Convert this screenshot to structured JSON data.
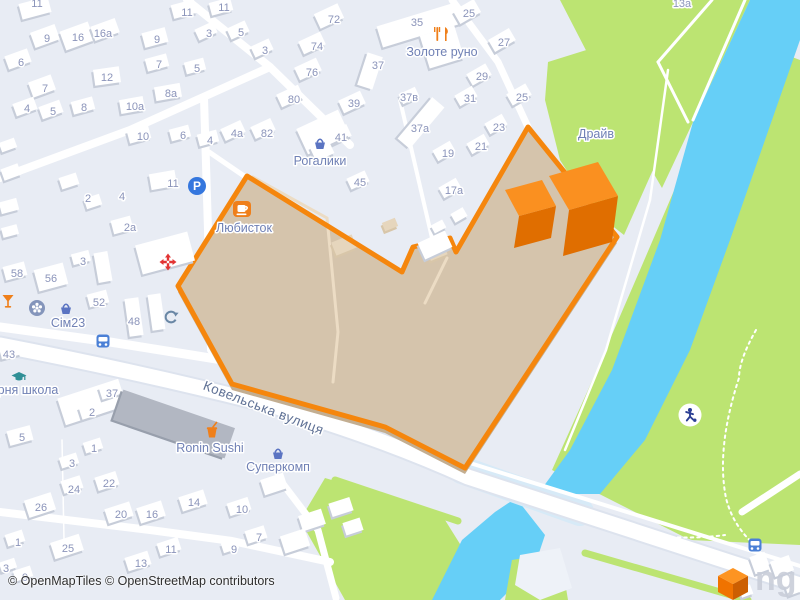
{
  "attribution": "© OpenMapTiles © OpenStreetMap contributors",
  "watermark": "ng",
  "colors": {
    "land": "#e8ecf4",
    "green": "#bce472",
    "water": "#66cff7",
    "bridge": "#d7eaf7",
    "road": "#ffffff",
    "road_casing": "#dde3ee",
    "building": "#ffffff",
    "building_shadow": "#c7cdd9",
    "building_gray": "#b2b7c2",
    "building_gray_shadow": "#989fac",
    "building_beige": "#e6d6bd",
    "selection_fill": "#d5c4ac",
    "selection_lip": "#c3ae91",
    "selection_border": "#f5860d",
    "selection_path": "#ecdcc4",
    "bld3d_top": "#fa9020",
    "bld3d_side": "#e06e00",
    "house_number": "#8b94ba",
    "poi_label": "#7081b5",
    "street_label": "#5f7195",
    "icon_orange": "#ef7f1a",
    "icon_blue": "#3577de",
    "icon_basket": "#5b74c2",
    "icon_red": "#e23434",
    "icon_slate": "#6a87a5",
    "icon_teal": "#2f8f96",
    "icon_navy": "#2b3f94",
    "logo_top": "#fd9422",
    "logo_left": "#f07300",
    "logo_right": "#cc5f02"
  },
  "selection": {
    "points": "247,176 402,272 413,247 450,238 456,252 528,127 617,237 465,468 385,427 232,384 178,286",
    "inner_paths": [
      "M253 177 L327 218 L338 332 L333 382",
      "M447 258 L425 303"
    ]
  },
  "areas": {
    "wedge_green": "560,0 750,0 693,122 662,188 640,150 592,62",
    "drive_green": "548,62 612,42 658,90 652,172 624,235 592,210 560,160 545,100",
    "park_green": "760,45 800,60 800,545 690,540 552,470 588,390 640,270 700,130",
    "bottomleft_green": "325,478 440,512 470,560 455,600 345,600 300,520",
    "bottomright_green": "512,560 560,552 568,600 505,600",
    "river": "750,0 800,0 800,40 772,120 730,240 690,350 645,440 600,494 538,494 570,450 612,370 660,240 693,122",
    "river_bottom": "516,498 545,535 535,565 500,600 432,600 462,540 495,512",
    "island": "520,555 560,548 572,588 540,600 515,585",
    "bridge": {
      "d": "M462 470 L580 512",
      "w": 28
    }
  },
  "verges": [
    {
      "d": "M238 392 L462 468",
      "w": 8
    },
    {
      "d": "M335 480 L458 521",
      "w": 7
    },
    {
      "d": "M585 553 L748 600",
      "w": 7
    }
  ],
  "roads": [
    {
      "d": "M0 345 Q140 372 270 405 Q380 437 468 477 L800 585",
      "w": 15,
      "casing": true
    },
    {
      "d": "M470 463 L800 566",
      "w": 4
    },
    {
      "d": "M0 327 L110 342 L235 362 L272 390",
      "w": 9
    },
    {
      "d": "M187 0 L270 67 L350 145",
      "w": 8
    },
    {
      "d": "M270 67 L130 130 L0 178",
      "w": 8
    },
    {
      "d": "M204 98 L208 230 L211 350",
      "w": 8
    },
    {
      "d": "M209 152 L247 178",
      "w": 5
    },
    {
      "d": "M452 0 L498 62 L528 127",
      "w": 7
    },
    {
      "d": "M400 100 L432 238",
      "w": 4
    },
    {
      "d": "M0 512 L150 530 L232 541 L330 562",
      "w": 8
    },
    {
      "d": "M280 480 L318 530 L336 598",
      "w": 7
    },
    {
      "d": "M742 512 L800 474",
      "w": 7
    },
    {
      "d": "M62 440 L64 540",
      "w": 1.5
    }
  ],
  "park_paths": [
    {
      "d": "M712 0 L658 62",
      "w": 3
    },
    {
      "d": "M658 62 L688 122",
      "w": 3
    },
    {
      "d": "M745 0 L693 120",
      "w": 3
    },
    {
      "d": "M668 70 L650 200 L606 350 L565 450",
      "w": 2.5
    },
    {
      "d": "M756 330 Q739 360 739 378 Q716 448 726 498 Q733 527 758 548",
      "w": 2,
      "dash": "2.5 4"
    },
    {
      "d": "M570 515 Q650 545 725 535",
      "w": 2,
      "dash": "2.5 4"
    }
  ],
  "buildings": [
    [
      20,
      0,
      30,
      16,
      -15
    ],
    [
      172,
      2,
      24,
      14,
      -15
    ],
    [
      210,
      0,
      22,
      13,
      -15
    ],
    [
      32,
      28,
      26,
      16,
      -20
    ],
    [
      62,
      26,
      30,
      20,
      -20
    ],
    [
      92,
      22,
      26,
      15,
      -20
    ],
    [
      143,
      30,
      24,
      15,
      -15
    ],
    [
      196,
      25,
      20,
      12,
      -25
    ],
    [
      228,
      24,
      20,
      12,
      -25
    ],
    [
      316,
      8,
      26,
      16,
      -25
    ],
    [
      6,
      52,
      24,
      14,
      -20
    ],
    [
      30,
      78,
      24,
      16,
      -20
    ],
    [
      94,
      68,
      26,
      16,
      -8
    ],
    [
      146,
      56,
      22,
      13,
      -15
    ],
    [
      185,
      60,
      20,
      12,
      -15
    ],
    [
      252,
      42,
      20,
      12,
      -25
    ],
    [
      300,
      36,
      24,
      14,
      -25
    ],
    [
      296,
      62,
      24,
      14,
      -25
    ],
    [
      14,
      100,
      22,
      13,
      -20
    ],
    [
      40,
      103,
      22,
      13,
      -20
    ],
    [
      72,
      99,
      22,
      13,
      -15
    ],
    [
      155,
      85,
      26,
      14,
      -10
    ],
    [
      120,
      98,
      24,
      14,
      -10
    ],
    [
      278,
      89,
      24,
      14,
      -25
    ],
    [
      252,
      122,
      22,
      13,
      -25
    ],
    [
      222,
      124,
      22,
      13,
      -25
    ],
    [
      128,
      128,
      22,
      13,
      -15
    ],
    [
      170,
      127,
      20,
      12,
      -15
    ],
    [
      198,
      132,
      20,
      12,
      -15
    ],
    [
      150,
      172,
      26,
      16,
      -10
    ],
    [
      0,
      140,
      16,
      10,
      -20
    ],
    [
      2,
      166,
      18,
      12,
      -20
    ],
    [
      60,
      175,
      18,
      12,
      -18
    ],
    [
      85,
      196,
      16,
      11,
      -18
    ],
    [
      0,
      200,
      18,
      12,
      -15
    ],
    [
      2,
      226,
      16,
      10,
      -15
    ],
    [
      138,
      238,
      54,
      30,
      -15
    ],
    [
      112,
      218,
      20,
      14,
      -15
    ],
    [
      378,
      14,
      82,
      22,
      -17
    ],
    [
      424,
      30,
      36,
      34,
      -17
    ],
    [
      362,
      54,
      16,
      34,
      18
    ],
    [
      340,
      95,
      24,
      14,
      -25
    ],
    [
      328,
      128,
      22,
      13,
      -25
    ],
    [
      348,
      174,
      20,
      12,
      -25
    ],
    [
      300,
      118,
      46,
      28,
      -25
    ],
    [
      312,
      142,
      20,
      16,
      -25
    ],
    [
      400,
      90,
      18,
      11,
      -25
    ],
    [
      413,
      96,
      16,
      54,
      40
    ],
    [
      455,
      4,
      24,
      15,
      -30
    ],
    [
      490,
      33,
      24,
      14,
      -30
    ],
    [
      468,
      68,
      22,
      13,
      -30
    ],
    [
      456,
      90,
      20,
      12,
      -30
    ],
    [
      508,
      88,
      22,
      13,
      -30
    ],
    [
      486,
      118,
      20,
      12,
      -30
    ],
    [
      434,
      145,
      20,
      12,
      -30
    ],
    [
      468,
      138,
      20,
      12,
      -30
    ],
    [
      440,
      182,
      20,
      12,
      -30
    ],
    [
      452,
      210,
      14,
      10,
      -30
    ],
    [
      432,
      222,
      13,
      9,
      -28
    ],
    [
      4,
      264,
      22,
      14,
      -15
    ],
    [
      36,
      266,
      30,
      22,
      -15
    ],
    [
      72,
      252,
      18,
      11,
      -15
    ],
    [
      96,
      252,
      14,
      30,
      -10
    ],
    [
      88,
      292,
      20,
      13,
      -15
    ],
    [
      127,
      298,
      14,
      38,
      -8
    ],
    [
      150,
      294,
      13,
      36,
      -8
    ],
    [
      0,
      344,
      20,
      13,
      -15
    ],
    [
      60,
      388,
      64,
      28,
      -18
    ],
    [
      100,
      384,
      20,
      13,
      -18
    ],
    [
      80,
      404,
      20,
      13,
      -18
    ],
    [
      8,
      428,
      24,
      15,
      -15
    ],
    [
      84,
      440,
      18,
      11,
      -18
    ],
    [
      60,
      455,
      18,
      11,
      -18
    ],
    [
      26,
      496,
      28,
      18,
      -18
    ],
    [
      62,
      478,
      20,
      13,
      -18
    ],
    [
      96,
      474,
      22,
      14,
      -18
    ],
    [
      106,
      505,
      26,
      15,
      -18
    ],
    [
      138,
      504,
      26,
      16,
      -18
    ],
    [
      180,
      493,
      26,
      15,
      -18
    ],
    [
      52,
      538,
      30,
      17,
      -18
    ],
    [
      158,
      540,
      22,
      13,
      -18
    ],
    [
      126,
      554,
      24,
      14,
      -18
    ],
    [
      6,
      532,
      18,
      12,
      -18
    ],
    [
      0,
      560,
      16,
      10,
      -18
    ],
    [
      14,
      568,
      18,
      11,
      -18
    ],
    [
      228,
      500,
      22,
      13,
      -18
    ],
    [
      246,
      528,
      20,
      13,
      -18
    ],
    [
      222,
      541,
      16,
      10,
      -18
    ],
    [
      300,
      512,
      24,
      16,
      -18
    ],
    [
      330,
      500,
      22,
      14,
      -18
    ],
    [
      282,
      532,
      26,
      18,
      -18
    ],
    [
      344,
      520,
      18,
      13,
      -18
    ],
    [
      262,
      476,
      24,
      16,
      -18
    ],
    [
      752,
      554,
      16,
      18,
      -20
    ],
    [
      772,
      558,
      20,
      16,
      -20
    ],
    [
      786,
      582,
      14,
      12,
      -20
    ],
    [
      740,
      586,
      12,
      10,
      -20
    ]
  ],
  "gray_buildings": [
    [
      115,
      408,
      118,
      32,
      19
    ]
  ],
  "beige_buildings": [
    [
      333,
      238,
      22,
      14,
      -22
    ],
    [
      383,
      220,
      14,
      9,
      -22
    ],
    [
      428,
      246,
      18,
      12,
      -22
    ]
  ],
  "notch_building": [
    420,
    236,
    30,
    18,
    -25
  ],
  "buildings_3d": [
    {
      "top": "505,190 542,180 556,206 519,216",
      "side": "519,216 556,206 551,238 514,248"
    },
    {
      "top": "549,176 598,162 618,196 569,210",
      "side": "569,210 618,196 612,242 563,256"
    }
  ],
  "street_label": {
    "text": "Ковельська вулиця",
    "x": 262,
    "y": 412,
    "rotate": 21,
    "size": 13.5
  },
  "poi_labels": [
    {
      "label": "Золоте руно",
      "icon": "forkknife",
      "ix": 442,
      "iy": 34,
      "lx": 442,
      "ly": 56
    },
    {
      "label": "Рогалики",
      "icon": "basket",
      "ix": 320,
      "iy": 144,
      "lx": 320,
      "ly": 165
    },
    {
      "label": "Любисток",
      "icon": "coffee",
      "ix": 242,
      "iy": 209,
      "lx": 244,
      "ly": 232
    },
    {
      "label": "Сім23",
      "icon": "basket",
      "ix": 66,
      "iy": 309,
      "lx": 68,
      "ly": 327
    },
    {
      "label": "Драйв",
      "icon": "",
      "ix": 0,
      "iy": 0,
      "lx": 596,
      "ly": 138
    },
    {
      "label": "Ronin Sushi",
      "icon": "fastfood",
      "ix": 212,
      "iy": 431,
      "lx": 210,
      "ly": 452
    },
    {
      "label": "Суперкомп",
      "icon": "basket",
      "ix": 278,
      "iy": 454,
      "lx": 278,
      "ly": 471
    },
    {
      "label": "рня школа",
      "icon": "school",
      "ix": 19,
      "iy": 376,
      "lx": 28,
      "ly": 394
    }
  ],
  "icons": [
    {
      "type": "parking",
      "x": 197,
      "y": 186
    },
    {
      "type": "hospital",
      "x": 168,
      "y": 262
    },
    {
      "type": "martini",
      "x": 8,
      "y": 301
    },
    {
      "type": "flower",
      "x": 37,
      "y": 308
    },
    {
      "type": "recycling",
      "x": 171,
      "y": 317
    },
    {
      "type": "bus",
      "x": 103,
      "y": 341
    },
    {
      "type": "bus",
      "x": 755,
      "y": 545
    },
    {
      "type": "playground",
      "x": 690,
      "y": 415
    }
  ],
  "house_numbers": [
    [
      "11",
      37,
      3
    ],
    [
      "11",
      187,
      12
    ],
    [
      "11",
      224,
      7
    ],
    [
      "9",
      47,
      38
    ],
    [
      "16",
      78,
      37
    ],
    [
      "16а",
      103,
      33
    ],
    [
      "9",
      157,
      39
    ],
    [
      "3",
      209,
      33
    ],
    [
      "5",
      241,
      32
    ],
    [
      "72",
      334,
      19
    ],
    [
      "6",
      21,
      62
    ],
    [
      "7",
      45,
      88
    ],
    [
      "12",
      107,
      77
    ],
    [
      "7",
      159,
      64
    ],
    [
      "5",
      197,
      68
    ],
    [
      "3",
      265,
      50
    ],
    [
      "74",
      317,
      46
    ],
    [
      "76",
      312,
      72
    ],
    [
      "4",
      27,
      108
    ],
    [
      "5",
      53,
      111
    ],
    [
      "8",
      84,
      107
    ],
    [
      "8а",
      171,
      93
    ],
    [
      "10а",
      135,
      106
    ],
    [
      "80",
      294,
      99
    ],
    [
      "82",
      267,
      133
    ],
    [
      "4а",
      237,
      133
    ],
    [
      "10",
      143,
      136
    ],
    [
      "6",
      183,
      135
    ],
    [
      "4",
      210,
      140
    ],
    [
      "11",
      173,
      183
    ],
    [
      "2",
      88,
      198
    ],
    [
      "4",
      122,
      196
    ],
    [
      "2а",
      130,
      227
    ],
    [
      "35",
      417,
      22
    ],
    [
      "37",
      378,
      65
    ],
    [
      "39",
      354,
      103
    ],
    [
      "41",
      341,
      137
    ],
    [
      "45",
      360,
      182
    ],
    [
      "37в",
      409,
      97
    ],
    [
      "37а",
      420,
      128
    ],
    [
      "25",
      469,
      13
    ],
    [
      "27",
      504,
      42
    ],
    [
      "29",
      482,
      76
    ],
    [
      "31",
      470,
      98
    ],
    [
      "25",
      522,
      97
    ],
    [
      "23",
      499,
      127
    ],
    [
      "19",
      448,
      153
    ],
    [
      "21",
      481,
      146
    ],
    [
      "17а",
      454,
      190
    ],
    [
      "13а",
      682,
      3
    ],
    [
      "58",
      17,
      273
    ],
    [
      "56",
      51,
      278
    ],
    [
      "3",
      83,
      261
    ],
    [
      "52",
      99,
      302
    ],
    [
      "48",
      134,
      321
    ],
    [
      "43",
      9,
      354
    ],
    [
      "37",
      112,
      393
    ],
    [
      "2",
      92,
      412
    ],
    [
      "5",
      22,
      437
    ],
    [
      "1",
      94,
      448
    ],
    [
      "3",
      72,
      463
    ],
    [
      "26",
      41,
      507
    ],
    [
      "24",
      74,
      489
    ],
    [
      "22",
      109,
      483
    ],
    [
      "20",
      121,
      514
    ],
    [
      "16",
      152,
      514
    ],
    [
      "14",
      194,
      502
    ],
    [
      "25",
      68,
      548
    ],
    [
      "11",
      171,
      549
    ],
    [
      "13",
      141,
      563
    ],
    [
      "1",
      18,
      542
    ],
    [
      "3",
      6,
      568
    ],
    [
      "9",
      25,
      577
    ],
    [
      "10",
      242,
      509
    ],
    [
      "7",
      259,
      537
    ],
    [
      "9",
      234,
      549
    ]
  ],
  "logo": {
    "top": "733,568 748,576 733,584 718,576",
    "left": "718,576 733,584 733,600 718,592",
    "right": "748,576 733,584 733,600 748,592"
  }
}
